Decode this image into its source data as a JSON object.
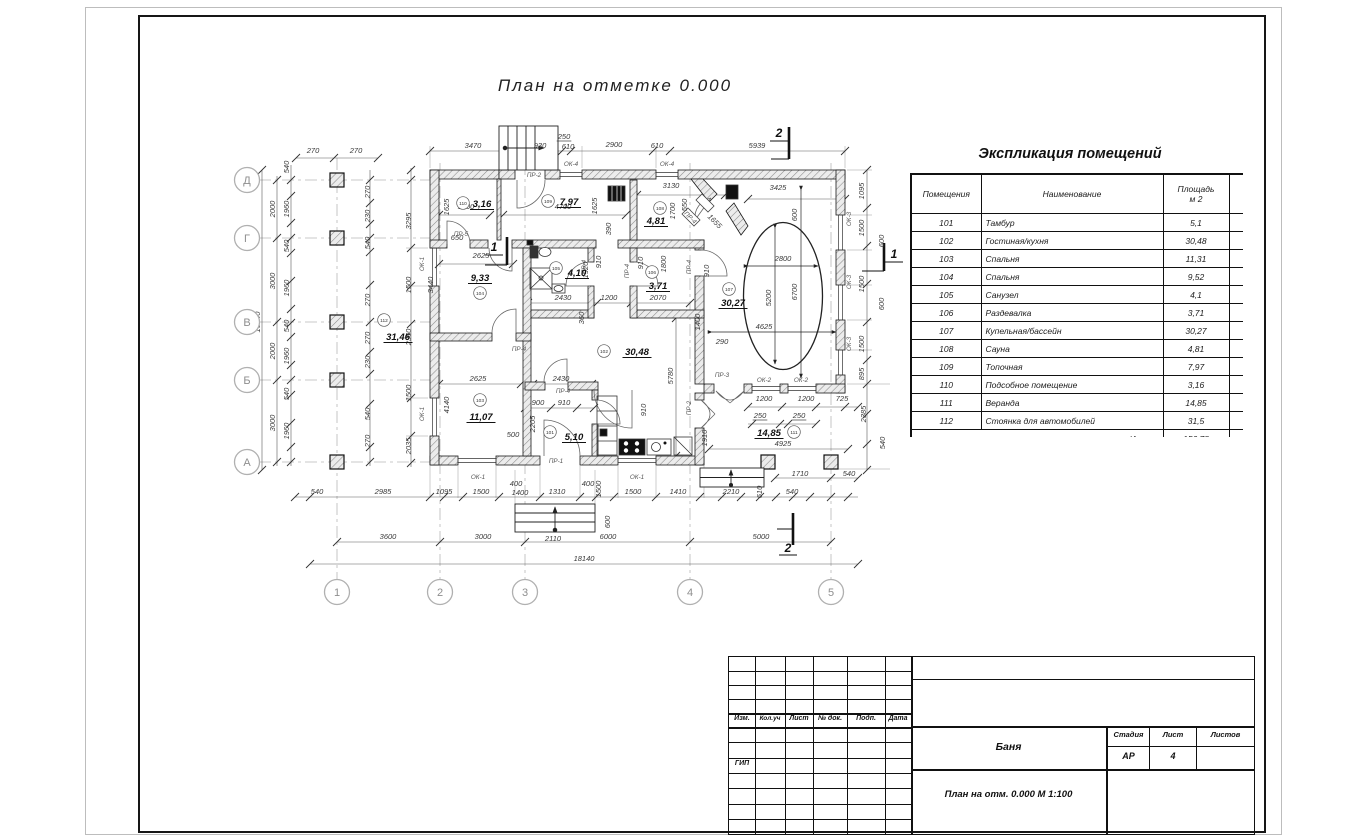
{
  "plan": {
    "title": "План на отметке 0.000",
    "axes_v": [
      {
        "x": 337,
        "n": "1"
      },
      {
        "x": 440,
        "n": "2"
      },
      {
        "x": 525,
        "n": "3"
      },
      {
        "x": 690,
        "n": "4"
      },
      {
        "x": 831,
        "n": "5"
      }
    ],
    "axes_h": [
      {
        "y": 180,
        "n": "Д"
      },
      {
        "y": 238,
        "n": "Г"
      },
      {
        "y": 322,
        "n": "В"
      },
      {
        "y": 380,
        "n": "Б"
      },
      {
        "y": 462,
        "n": "А"
      }
    ],
    "sections": [
      {
        "x": 779,
        "y": 137,
        "n": "2"
      },
      {
        "x": 788,
        "y": 552,
        "n": "2"
      },
      {
        "x": 494,
        "y": 251,
        "n": "1"
      },
      {
        "x": 894,
        "y": 258,
        "n": "1"
      }
    ],
    "rooms": [
      {
        "n": "110",
        "cx": 463,
        "cy": 203,
        "a": "3,16",
        "ax": 482,
        "ay": 207
      },
      {
        "n": "109",
        "cx": 548,
        "cy": 201,
        "a": "7,97",
        "ax": 569,
        "ay": 205
      },
      {
        "n": "108",
        "cx": 660,
        "cy": 208,
        "a": "4,81",
        "ax": 656,
        "ay": 224
      },
      {
        "n": "104",
        "cx": 480,
        "cy": 293,
        "a": "9,33",
        "ax": 480,
        "ay": 281
      },
      {
        "n": "105",
        "cx": 556,
        "cy": 268,
        "a": "4,10",
        "ax": 577,
        "ay": 276
      },
      {
        "n": "106",
        "cx": 652,
        "cy": 272,
        "a": "3,71",
        "ax": 658,
        "ay": 289
      },
      {
        "n": "107",
        "cx": 729,
        "cy": 289,
        "a": "30,27",
        "ax": 733,
        "ay": 306
      },
      {
        "n": "102",
        "cx": 604,
        "cy": 351,
        "a": "30,48",
        "ax": 637,
        "ay": 355
      },
      {
        "n": "103",
        "cx": 480,
        "cy": 400,
        "a": "11,07",
        "ax": 481,
        "ay": 420
      },
      {
        "n": "101",
        "cx": 550,
        "cy": 432,
        "a": "5,10",
        "ax": 574,
        "ay": 440
      },
      {
        "n": "111",
        "cx": 794,
        "cy": 432,
        "a": "14,85",
        "ax": 769,
        "ay": 436
      },
      {
        "n": "112",
        "cx": 384,
        "cy": 320,
        "a": "31,46",
        "ax": 398,
        "ay": 340
      }
    ],
    "labels": [
      [
        473,
        148,
        "3470"
      ],
      [
        540,
        148,
        "930"
      ],
      [
        564,
        139,
        "250",
        0,
        "d",
        1
      ],
      [
        568,
        149,
        "610"
      ],
      [
        614,
        147,
        "2900"
      ],
      [
        657,
        148,
        "610"
      ],
      [
        757,
        148,
        "5939"
      ],
      [
        313,
        153,
        "270"
      ],
      [
        356,
        153,
        "270"
      ],
      [
        260,
        322,
        "10540",
        -90
      ],
      [
        275,
        209,
        "2000",
        -90
      ],
      [
        275,
        281,
        "3000",
        -90
      ],
      [
        275,
        351,
        "2000",
        -90
      ],
      [
        275,
        423,
        "3000",
        -90
      ],
      [
        289,
        167,
        "540",
        -90
      ],
      [
        289,
        209,
        "1960",
        -90
      ],
      [
        289,
        246,
        "540",
        -90
      ],
      [
        289,
        288,
        "1960",
        -90
      ],
      [
        289,
        326,
        "540",
        -90
      ],
      [
        289,
        356,
        "1960",
        -90
      ],
      [
        289,
        394,
        "540",
        -90
      ],
      [
        289,
        431,
        "1960",
        -90
      ],
      [
        370,
        192,
        "270",
        -90
      ],
      [
        370,
        216,
        "230",
        -90
      ],
      [
        370,
        243,
        "540",
        -90
      ],
      [
        370,
        300,
        "270",
        -90
      ],
      [
        370,
        338,
        "270",
        -90
      ],
      [
        370,
        362,
        "230",
        -90
      ],
      [
        370,
        414,
        "540",
        -90
      ],
      [
        370,
        441,
        "270",
        -90
      ],
      [
        411,
        221,
        "3295",
        -90
      ],
      [
        411,
        285,
        "1500",
        -90
      ],
      [
        411,
        337,
        "2360",
        -90
      ],
      [
        411,
        393,
        "1500",
        -90
      ],
      [
        411,
        446,
        "2035",
        -90
      ],
      [
        424,
        264,
        "ОК-1",
        -90,
        "s"
      ],
      [
        424,
        414,
        "ОК-1",
        -90,
        "s"
      ],
      [
        317,
        494,
        "540"
      ],
      [
        383,
        494,
        "2985"
      ],
      [
        444,
        494,
        "1095"
      ],
      [
        481,
        494,
        "1500"
      ],
      [
        516,
        486,
        "400"
      ],
      [
        520,
        495,
        "1400"
      ],
      [
        557,
        494,
        "1310"
      ],
      [
        588,
        486,
        "400"
      ],
      [
        601,
        489,
        "1500",
        -90
      ],
      [
        633,
        494,
        "1500"
      ],
      [
        678,
        494,
        "1410"
      ],
      [
        731,
        494,
        "2210"
      ],
      [
        762,
        492,
        "610",
        -90
      ],
      [
        792,
        494,
        "540"
      ],
      [
        800,
        476,
        "1710"
      ],
      [
        849,
        476,
        "540"
      ],
      [
        610,
        522,
        "600",
        -90
      ],
      [
        553,
        541,
        "2110"
      ],
      [
        388,
        539,
        "3600"
      ],
      [
        483,
        539,
        "3000"
      ],
      [
        608,
        539,
        "6000"
      ],
      [
        761,
        539,
        "5000"
      ],
      [
        584,
        561,
        "18140"
      ],
      [
        864,
        191,
        "1095",
        -90
      ],
      [
        864,
        228,
        "1500",
        -90
      ],
      [
        864,
        284,
        "1500",
        -90
      ],
      [
        864,
        344,
        "1500",
        -90
      ],
      [
        864,
        374,
        "895",
        -90
      ],
      [
        884,
        241,
        "600",
        -90
      ],
      [
        884,
        304,
        "600",
        -90
      ],
      [
        866,
        414,
        "2385",
        -90
      ],
      [
        885,
        443,
        "540",
        -90
      ],
      [
        842,
        401,
        "725"
      ],
      [
        851,
        219,
        "ОК-3",
        -90,
        "s"
      ],
      [
        851,
        282,
        "ОК-3",
        -90,
        "s"
      ],
      [
        851,
        344,
        "ОК-3",
        -90,
        "s"
      ],
      [
        778,
        190,
        "3425"
      ],
      [
        797,
        215,
        "600",
        -90
      ],
      [
        783,
        261,
        "2800"
      ],
      [
        771,
        298,
        "5200",
        -90
      ],
      [
        797,
        292,
        "6700",
        -90
      ],
      [
        764,
        329,
        "4625"
      ],
      [
        722,
        344,
        "290"
      ],
      [
        700,
        322,
        "1400",
        -90
      ],
      [
        466,
        209,
        "1800"
      ],
      [
        449,
        207,
        "1625",
        -90
      ],
      [
        563,
        209,
        "4700"
      ],
      [
        597,
        206,
        "1625",
        -90
      ],
      [
        671,
        188,
        "3130"
      ],
      [
        675,
        211,
        "1700",
        -90
      ],
      [
        687,
        205,
        "550",
        -90
      ],
      [
        713,
        223,
        "1655",
        45
      ],
      [
        611,
        229,
        "390",
        -90
      ],
      [
        481,
        258,
        "2625"
      ],
      [
        457,
        240,
        "650"
      ],
      [
        433,
        285,
        "3440",
        -90
      ],
      [
        563,
        300,
        "2430"
      ],
      [
        609,
        300,
        "1200"
      ],
      [
        658,
        300,
        "2070"
      ],
      [
        588,
        270,
        "1920",
        -90
      ],
      [
        601,
        262,
        "910",
        -90
      ],
      [
        643,
        263,
        "910",
        -90
      ],
      [
        709,
        271,
        "910",
        -90
      ],
      [
        666,
        264,
        "1800",
        -90
      ],
      [
        584,
        318,
        "360",
        -90
      ],
      [
        478,
        381,
        "2625"
      ],
      [
        561,
        381,
        "2430"
      ],
      [
        538,
        405,
        "900"
      ],
      [
        564,
        405,
        "910"
      ],
      [
        535,
        424,
        "2205",
        -90
      ],
      [
        513,
        437,
        "500"
      ],
      [
        449,
        405,
        "4140",
        -90
      ],
      [
        673,
        376,
        "5780",
        -90
      ],
      [
        646,
        410,
        "910",
        -90
      ],
      [
        707,
        438,
        "1910",
        -90
      ],
      [
        764,
        401,
        "1200"
      ],
      [
        806,
        401,
        "1200"
      ],
      [
        760,
        418,
        "250",
        0,
        "d",
        1
      ],
      [
        799,
        418,
        "250",
        0,
        "d",
        1
      ],
      [
        783,
        446,
        "4925"
      ],
      [
        478,
        479,
        "ОК-1",
        0,
        "s"
      ],
      [
        637,
        479,
        "ОК-1",
        0,
        "s"
      ],
      [
        571,
        166,
        "ОК-4",
        0,
        "s"
      ],
      [
        667,
        166,
        "ОК-4",
        0,
        "s"
      ],
      [
        764,
        382,
        "ОК-2",
        0,
        "s"
      ],
      [
        801,
        382,
        "ОК-2",
        0,
        "s"
      ],
      [
        556,
        463,
        "ПР-1",
        0,
        "s"
      ],
      [
        534,
        177,
        "ПР-2",
        0,
        "s"
      ],
      [
        691,
        408,
        "ПР-2",
        -90,
        "s"
      ],
      [
        722,
        377,
        "ПР-3",
        0,
        "s"
      ],
      [
        461,
        236,
        "ПР-5",
        0,
        "s"
      ],
      [
        519,
        351,
        "ПР-4",
        0,
        "s"
      ],
      [
        563,
        393,
        "ПР-4",
        0,
        "s"
      ],
      [
        586,
        267,
        "ПР-4",
        -90,
        "s"
      ],
      [
        629,
        271,
        "ПР-4",
        -90,
        "s"
      ],
      [
        691,
        267,
        "ПР-4",
        -90,
        "s"
      ],
      [
        689,
        219,
        "ПР-4",
        45,
        "s"
      ]
    ]
  },
  "explication": {
    "title": "Экспликация помещений",
    "headers": [
      "Помещения",
      "Наименование",
      "Площадь\nм 2",
      "К\nж"
    ],
    "rows": [
      [
        "101",
        "Тамбур",
        "5,1",
        ""
      ],
      [
        "102",
        "Гостиная/кухня",
        "30,48",
        ""
      ],
      [
        "103",
        "Спальня",
        "11,31",
        ""
      ],
      [
        "104",
        "Спальня",
        "9,52",
        ""
      ],
      [
        "105",
        "Санузел",
        "4,1",
        ""
      ],
      [
        "106",
        "Раздевалка",
        "3,71",
        ""
      ],
      [
        "107",
        "Купельная/бассейн",
        "30,27",
        ""
      ],
      [
        "108",
        "Сауна",
        "4,81",
        ""
      ],
      [
        "109",
        "Топочная",
        "7,97",
        ""
      ],
      [
        "110",
        "Подсобное помещение",
        "3,16",
        ""
      ],
      [
        "111",
        "Веранда",
        "14,85",
        ""
      ],
      [
        "112",
        "Стоянка для автомобилей",
        "31,5",
        "3"
      ]
    ],
    "total_label": "Итого:",
    "total": "156,78",
    "total_extra": "1"
  },
  "titleblock": {
    "left_cols": [
      "Изм.",
      "Кол.уч",
      "Лист",
      "№ док.",
      "Подп.",
      "Дата"
    ],
    "gip": "ГИП",
    "project": "Баня",
    "stage_label": "Стадия",
    "sheet_label": "Лист",
    "sheets_label": "Листов",
    "stage": "АР",
    "sheet_no": "4",
    "sheets": "",
    "doc": "План на отм. 0.000  М 1:100"
  }
}
